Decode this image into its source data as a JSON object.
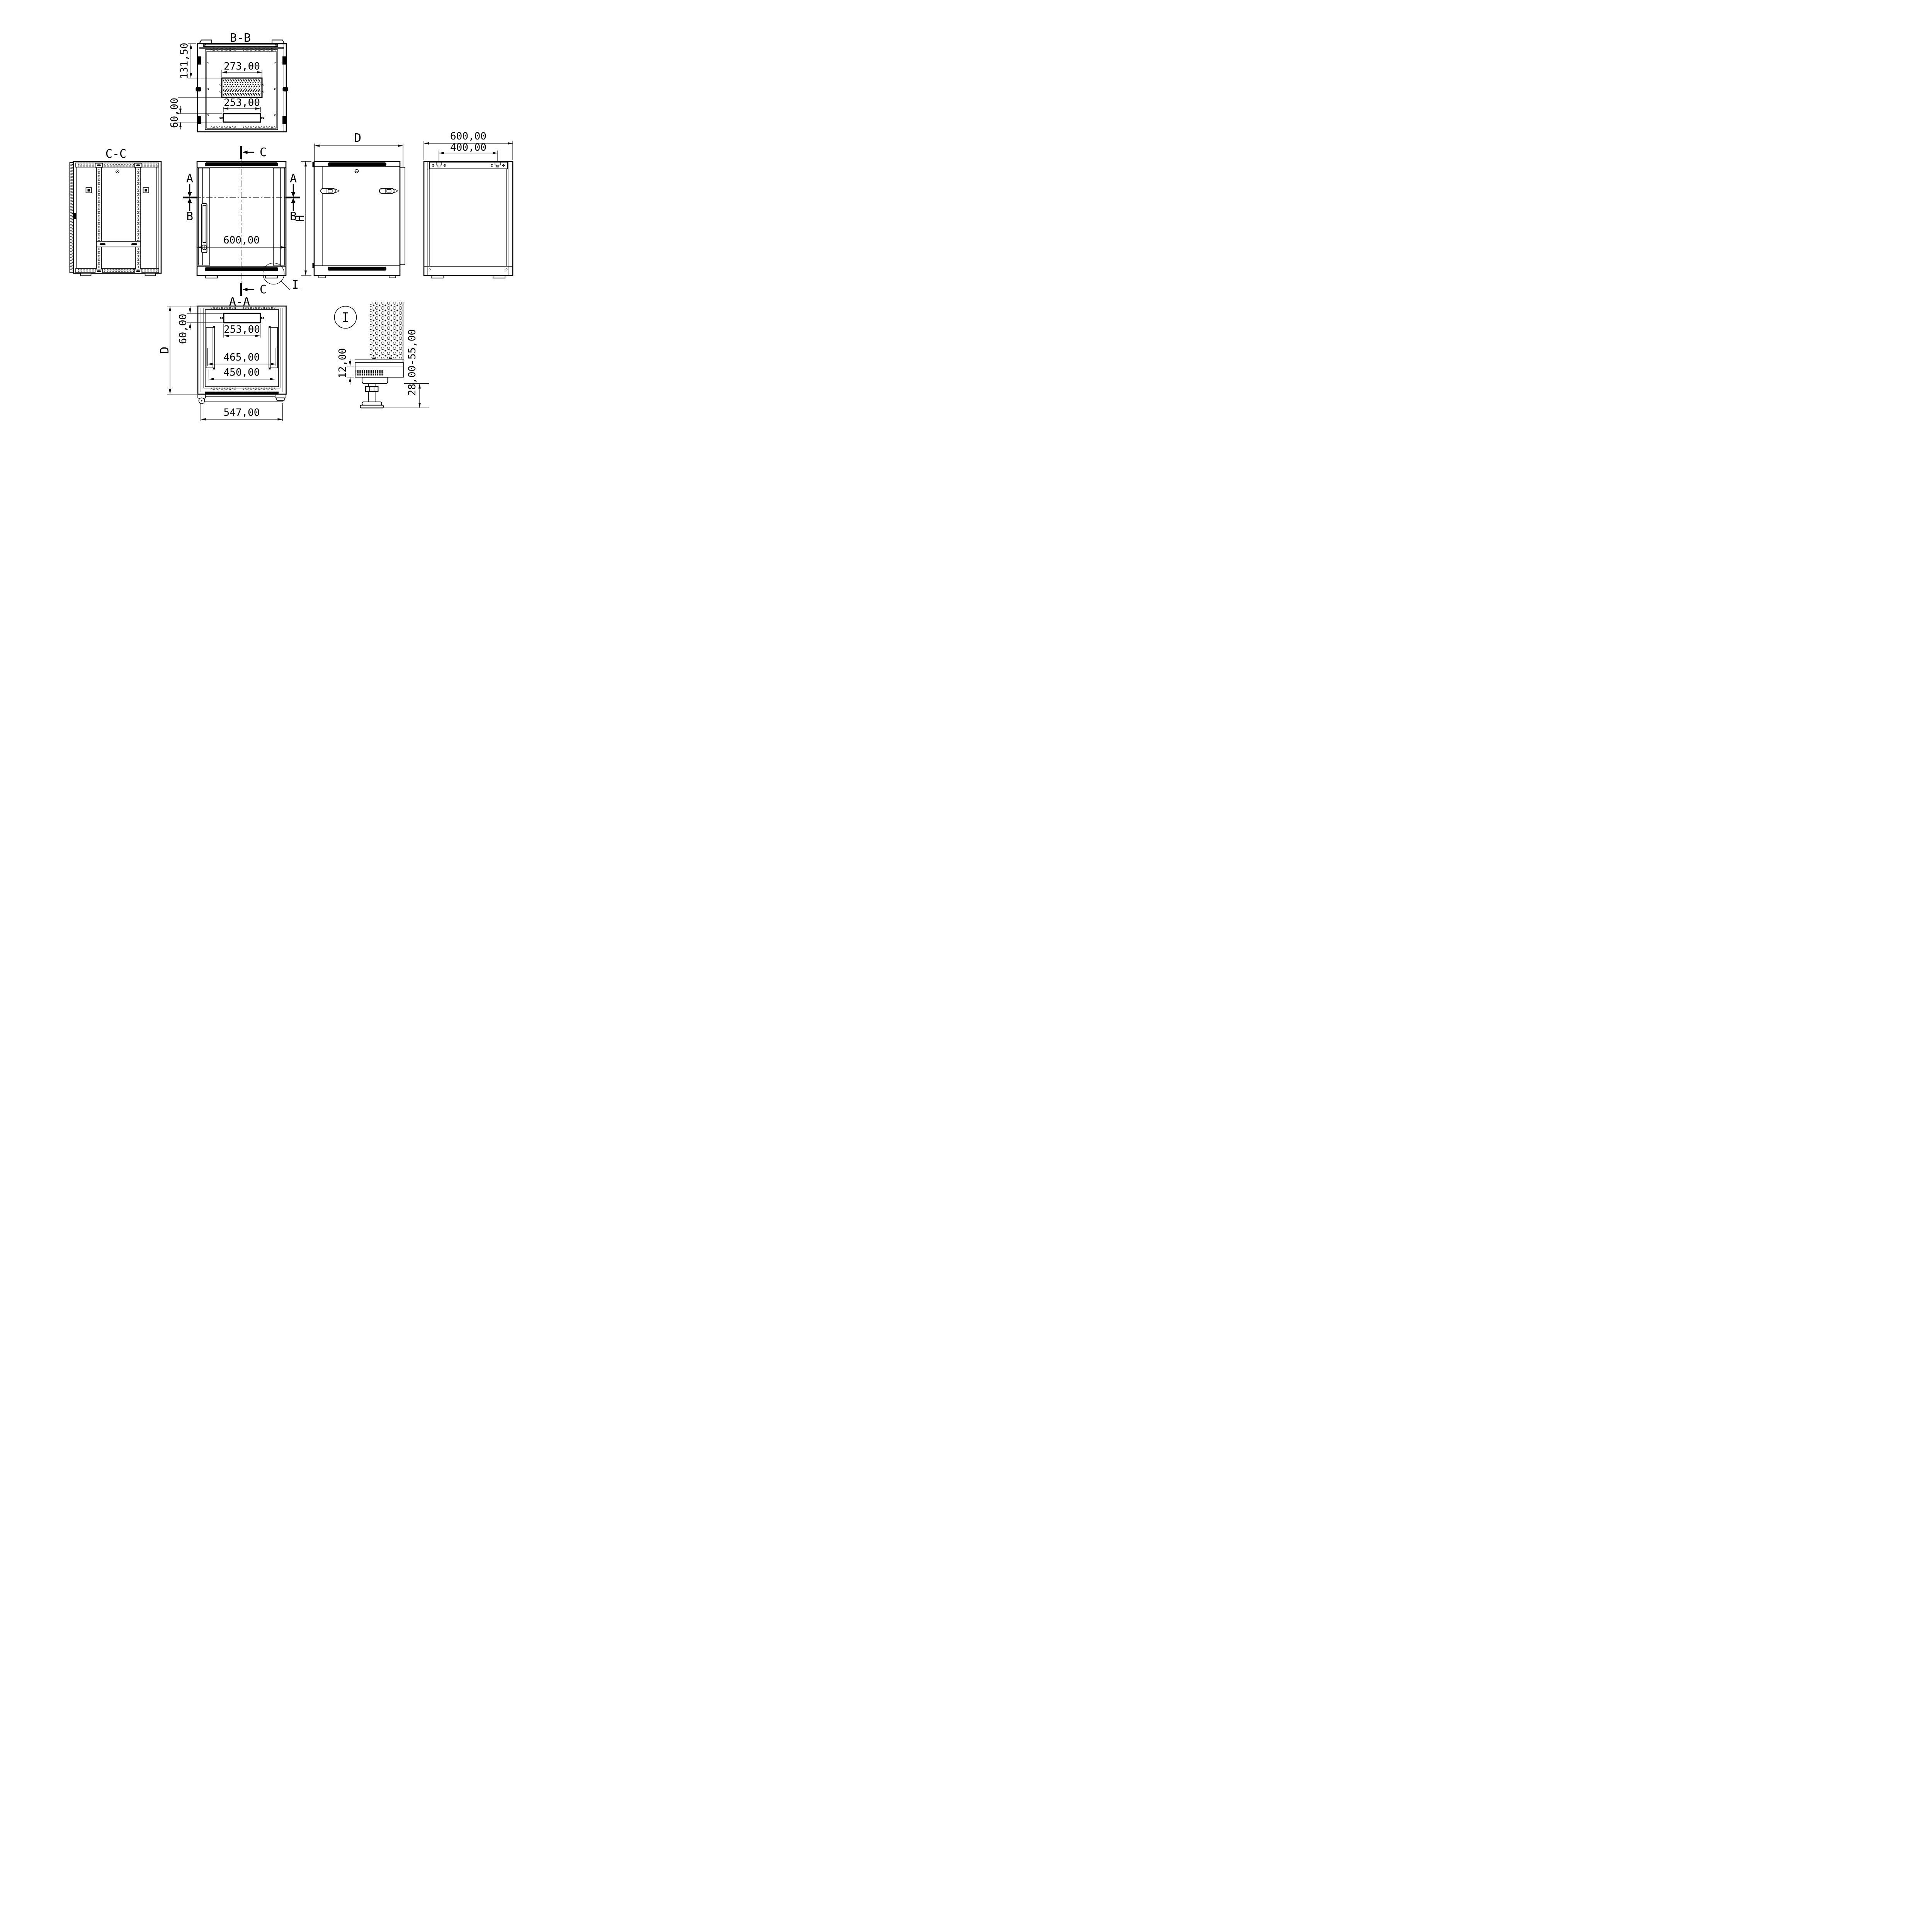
{
  "page": {
    "background": "#ffffff",
    "ink": "#000000"
  },
  "views": {
    "section_bb": {
      "title": "B-B",
      "dim_vent_offset": "131,50",
      "dim_vent_width": "273,00",
      "dim_cable_height": "60,00",
      "dim_cable_width": "253,00"
    },
    "section_cc": {
      "title": "C-C"
    },
    "front": {
      "dim_width": "600,00",
      "cut_a": "A",
      "cut_b": "B",
      "cut_c": "C",
      "detail_ref": "I",
      "height_ref": "H"
    },
    "side": {
      "depth_ref": "D"
    },
    "rear": {
      "dim_width": "600,00",
      "dim_mount_spacing": "400,00"
    },
    "section_aa": {
      "title": "A-A",
      "dim_cable_height": "60,00",
      "dim_cable_width": "253,00",
      "dim_rail_outer": "465,00",
      "dim_rail_inner": "450,00",
      "dim_base_depth": "547,00",
      "depth_ref": "D"
    },
    "detail_i": {
      "title": "I",
      "dim_lip": "12,00",
      "dim_foot_range": "28,00-55,00"
    }
  }
}
